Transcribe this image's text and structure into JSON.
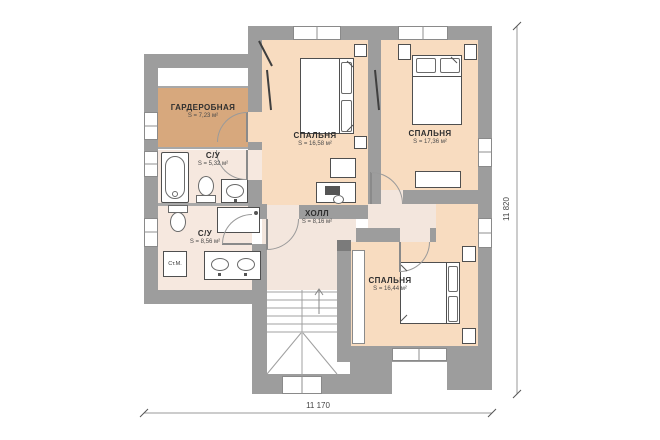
{
  "plan": {
    "rooms": [
      {
        "id": "wardrobe",
        "name": "ГАРДЕРОБНАЯ",
        "area": "S = 7,23 м²"
      },
      {
        "id": "bedroom-1",
        "name": "СПАЛЬНЯ",
        "area": "S = 16,58 м²"
      },
      {
        "id": "bedroom-2",
        "name": "СПАЛЬНЯ",
        "area": "S = 17,36 м²"
      },
      {
        "id": "bathroom-1",
        "name": "С/У",
        "area": "S = 5,32 м²"
      },
      {
        "id": "bathroom-2",
        "name": "С/У",
        "area": "S = 8,56 м²"
      },
      {
        "id": "hall",
        "name": "ХОЛЛ",
        "area": "S = 8,16 м²"
      },
      {
        "id": "bedroom-3",
        "name": "СПАЛЬНЯ",
        "area": "S = 16,44 м²"
      }
    ],
    "labels": {
      "washing_machine": "Ст.М."
    },
    "dimensions": {
      "width_mm": "11 170",
      "height_mm": "11 820"
    },
    "colors": {
      "wall": "#9d9d9d",
      "bedroom_fill": "#f8dcc0",
      "wardrobe_fill": "#d7a87d",
      "bathroom_fill": "#f6e8df",
      "hall_fill": "#f3e6dd"
    }
  }
}
